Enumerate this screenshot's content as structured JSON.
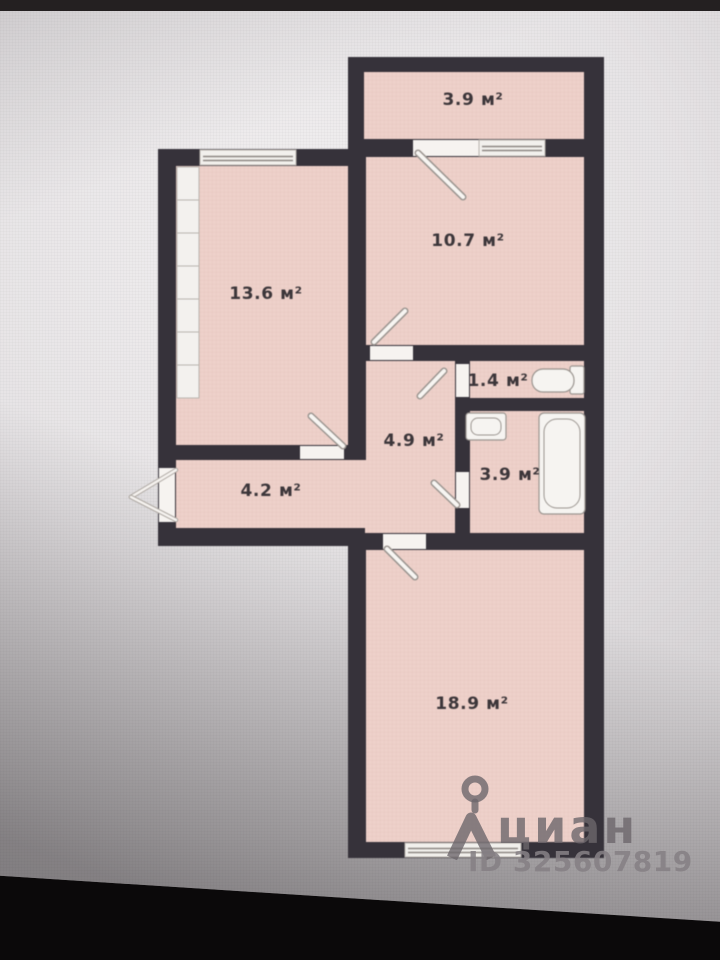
{
  "floor_plan": {
    "rooms": [
      {
        "name": "balcony",
        "label": "3.9 м²"
      },
      {
        "name": "bedroom",
        "label": "10.7 м²"
      },
      {
        "name": "room",
        "label": "13.6 м²"
      },
      {
        "name": "wc",
        "label": "1.4 м²"
      },
      {
        "name": "hall",
        "label": "4.9 м²"
      },
      {
        "name": "bathroom",
        "label": "3.9 м²"
      },
      {
        "name": "corridor",
        "label": "4.2 м²"
      },
      {
        "name": "living-room",
        "label": "18.9 м²"
      }
    ],
    "colors": {
      "room_fill": "#eed1ca",
      "wall": "#36323a",
      "fixture_fill": "#f6f4f1",
      "fixture_stroke": "#9b9590",
      "label_text": "#3c363a"
    }
  },
  "watermark": {
    "brand": "циан",
    "id_text": "ID 325607819"
  }
}
